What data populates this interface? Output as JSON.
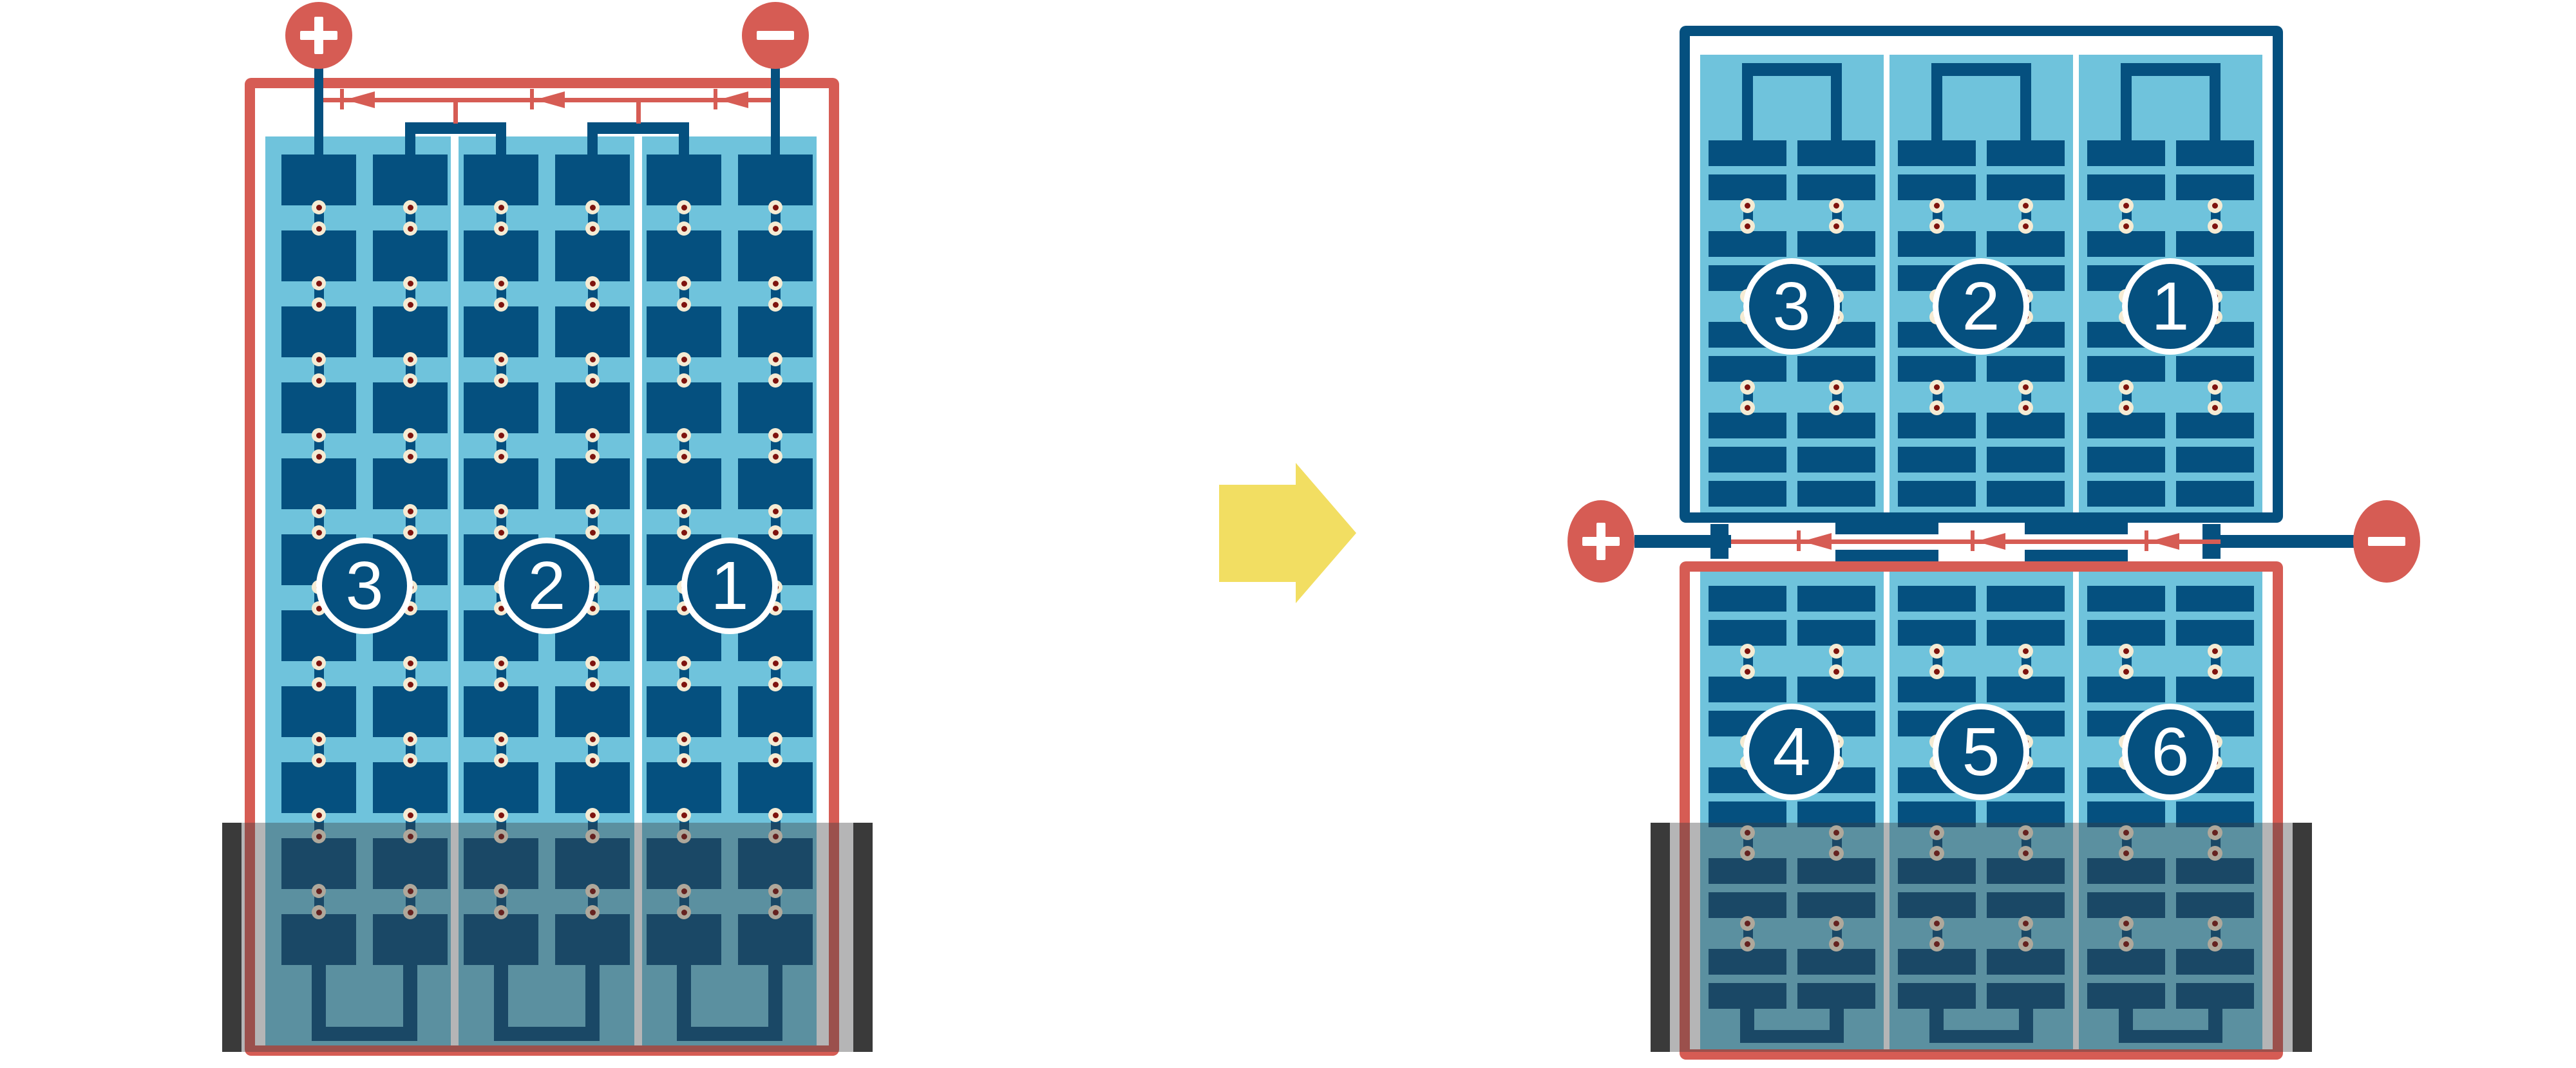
{
  "diagram": {
    "colors": {
      "red": "#D65C54",
      "dark_blue": "#05507F",
      "light_blue": "#6FC3DC",
      "cream": "#F5EBD3",
      "maroon": "#7E130E",
      "yellow": "#F2DE62",
      "shade_overlay": "rgba(60,60,62,0.38)",
      "end_bar": "#3A3A3A"
    },
    "arrow": {
      "direction": "right"
    },
    "left_module": {
      "terminals": {
        "positive": "+",
        "negative": "−"
      },
      "bypass_diodes": 3,
      "strings": [
        {
          "label": "3"
        },
        {
          "label": "2"
        },
        {
          "label": "1"
        }
      ]
    },
    "right_module": {
      "terminals": {
        "positive": "+",
        "negative": "−"
      },
      "bypass_diodes": 3,
      "top_strings": [
        {
          "label": "3"
        },
        {
          "label": "2"
        },
        {
          "label": "1"
        }
      ],
      "bottom_strings": [
        {
          "label": "4"
        },
        {
          "label": "5"
        },
        {
          "label": "6"
        }
      ]
    }
  }
}
